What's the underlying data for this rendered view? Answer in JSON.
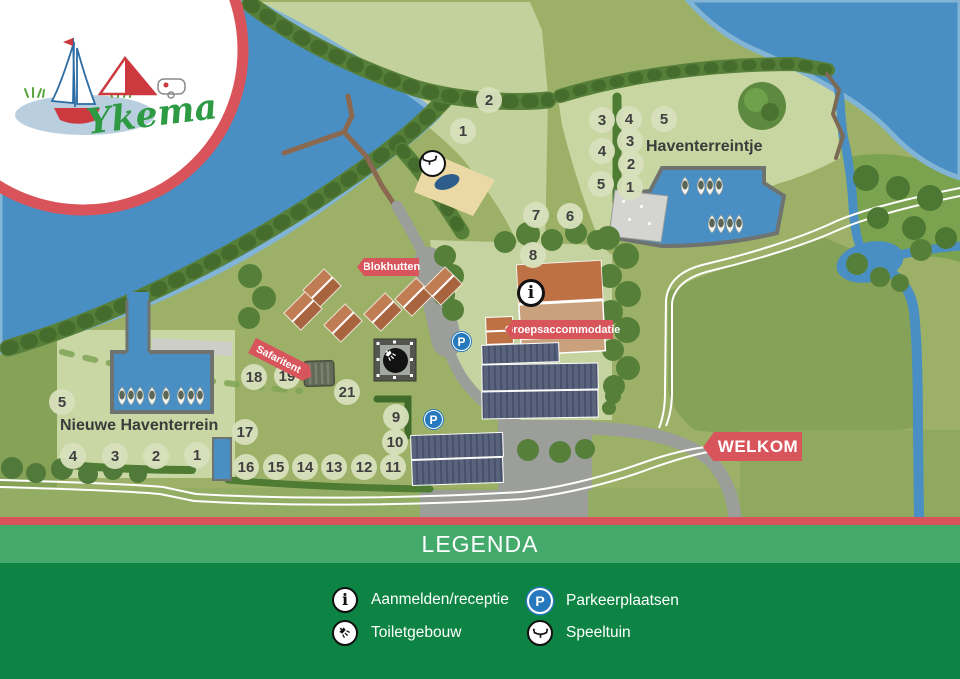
{
  "logo": {
    "brand": "Ykema"
  },
  "map": {
    "area_labels": {
      "haventerreintje": "Haventerreintje",
      "nieuwe_haventerrein": "Nieuwe Haventerrein"
    },
    "banners": {
      "blokhutten": "Blokhutten",
      "safaritent": "Safaritent",
      "groepsaccommodatie": "Groepsaccommodatie",
      "welkom": "WELKOM"
    },
    "plot_numbers": [
      {
        "n": "1",
        "x": 463,
        "y": 131
      },
      {
        "n": "2",
        "x": 489,
        "y": 100
      },
      {
        "n": "3",
        "x": 602,
        "y": 120
      },
      {
        "n": "4",
        "x": 629,
        "y": 119
      },
      {
        "n": "5",
        "x": 664,
        "y": 119
      },
      {
        "n": "4",
        "x": 602,
        "y": 151
      },
      {
        "n": "3",
        "x": 630,
        "y": 141
      },
      {
        "n": "2",
        "x": 631,
        "y": 164
      },
      {
        "n": "5",
        "x": 601,
        "y": 184
      },
      {
        "n": "1",
        "x": 630,
        "y": 187
      },
      {
        "n": "7",
        "x": 536,
        "y": 215
      },
      {
        "n": "6",
        "x": 570,
        "y": 216
      },
      {
        "n": "8",
        "x": 533,
        "y": 255
      },
      {
        "n": "18",
        "x": 254,
        "y": 377
      },
      {
        "n": "19",
        "x": 287,
        "y": 376
      },
      {
        "n": "21",
        "x": 347,
        "y": 392
      },
      {
        "n": "9",
        "x": 396,
        "y": 417
      },
      {
        "n": "10",
        "x": 395,
        "y": 442
      },
      {
        "n": "17",
        "x": 245,
        "y": 432
      },
      {
        "n": "16",
        "x": 246,
        "y": 467
      },
      {
        "n": "15",
        "x": 276,
        "y": 467
      },
      {
        "n": "14",
        "x": 305,
        "y": 467
      },
      {
        "n": "13",
        "x": 334,
        "y": 467
      },
      {
        "n": "12",
        "x": 364,
        "y": 467
      },
      {
        "n": "11",
        "x": 393,
        "y": 467
      },
      {
        "n": "5",
        "x": 62,
        "y": 402
      },
      {
        "n": "4",
        "x": 73,
        "y": 456
      },
      {
        "n": "3",
        "x": 115,
        "y": 456
      },
      {
        "n": "2",
        "x": 156,
        "y": 456
      },
      {
        "n": "1",
        "x": 197,
        "y": 455
      }
    ]
  },
  "icons": {
    "info_glyph": "i",
    "parking_glyph": "P"
  },
  "legend": {
    "title": "LEGENDA",
    "items": [
      {
        "icon": "info-icon",
        "label": "Aanmelden/receptie"
      },
      {
        "icon": "parking-icon",
        "label": "Parkeerplaatsen"
      },
      {
        "icon": "shower-icon",
        "label": "Toiletgebouw"
      },
      {
        "icon": "playground-icon",
        "label": "Speeltuin"
      }
    ]
  },
  "colors": {
    "water": "#4a8fc3",
    "water_shallow": "#82b4d6",
    "grass_base": "#9cb167",
    "field_pale": "#c8d6a2",
    "field_dark": "#86a158",
    "trees": "#567f39",
    "trees_dark": "#456c2c",
    "road_gray": "#9c9e99",
    "banner_red": "#d8555c",
    "legend_red": "#d9545a",
    "legend_green_light": "#44aa6b",
    "legend_green_dark": "#0d8443",
    "building_brown": "#b5724d",
    "building_tan": "#c9a17c",
    "building_dark": "#59637c",
    "parking_blue": "#2779bd",
    "logo_green": "#2f9a44"
  }
}
